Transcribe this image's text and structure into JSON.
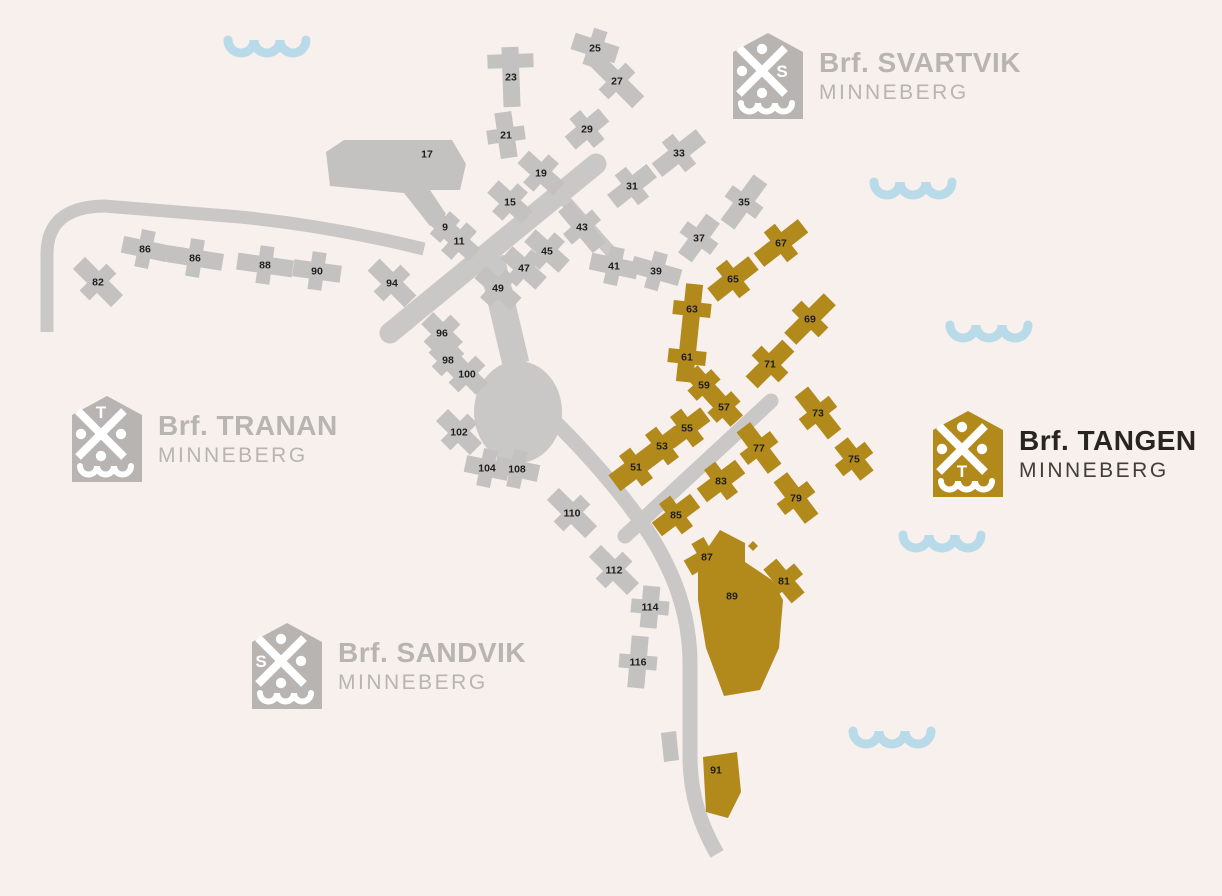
{
  "page": {
    "background": "#f7f0ec"
  },
  "colors": {
    "background": "#f7f0ec",
    "gray_building": "#c3c2c0",
    "road": "#c9c8c6",
    "gold": "#b28a1c",
    "wave": "#b9dbe9",
    "label": "#1d1d1b",
    "logo_gray": "#b7b4b1",
    "logo_dark_title": "#282520",
    "logo_dark_sub": "#413e37",
    "icon_glyph": "#ffffff"
  },
  "legend": {
    "items": [
      {
        "id": "svartvik",
        "label": "Brf. SVARTVIK",
        "subtitle": "MINNEBERG",
        "letter": "S",
        "letter_pos": "right",
        "theme": "gray",
        "x": 733,
        "y": 33
      },
      {
        "id": "tranan",
        "label": "Brf. TRANAN",
        "subtitle": "MINNEBERG",
        "letter": "T",
        "letter_pos": "top",
        "theme": "gray",
        "x": 72,
        "y": 396
      },
      {
        "id": "sandvik",
        "label": "Brf. SANDVIK",
        "subtitle": "MINNEBERG",
        "letter": "S",
        "letter_pos": "left",
        "theme": "gray",
        "x": 252,
        "y": 623
      },
      {
        "id": "tangen",
        "label": "Brf. TANGEN",
        "subtitle": "MINNEBERG",
        "letter": "T",
        "letter_pos": "bottom",
        "theme": "gold",
        "x": 933,
        "y": 411
      }
    ]
  },
  "map": {
    "roads": [
      {
        "name": "road-left-curve",
        "d": "M 47,332 L 47,254 Q 47,207 104,206 L 240,217 Q 330,226 424,249",
        "w": 13,
        "cap": "butt"
      },
      {
        "name": "road-main-diagonal",
        "d": "M 596,164 L 390,333",
        "w": 21,
        "cap": "round"
      },
      {
        "name": "road-northeast-branch",
        "d": "M 562,197 L 618,260",
        "w": 12,
        "cap": "butt"
      },
      {
        "name": "road-junction-connector",
        "d": "M 491,258 L 516,364",
        "w": 27,
        "cap": "butt"
      },
      {
        "name": "road-south",
        "d": "M 518,388 C 570,432 624,494 652,538 C 674,574 690,614 690,664 L 690,756 C 690,794 700,824 717,854",
        "w": 15,
        "cap": "butt"
      },
      {
        "name": "road-tangen-spur",
        "d": "M 771,401 L 625,536",
        "w": 15,
        "cap": "round"
      }
    ],
    "road_blob": {
      "cx": 518,
      "cy": 412,
      "rx": 44,
      "ry": 51
    },
    "buildings": [
      {
        "label": "25",
        "x": 595,
        "y": 48,
        "rot": 18,
        "len": 46,
        "type": "gray"
      },
      {
        "label": "27",
        "x": 617,
        "y": 81,
        "rot": 45,
        "len": 60,
        "type": "gray"
      },
      {
        "label": "23",
        "x": 511,
        "y": 77,
        "rot": 88,
        "len": 60,
        "ao": -16,
        "al": 46,
        "type": "gray"
      },
      {
        "label": "21",
        "x": 506,
        "y": 135,
        "rot": 82,
        "len": 46,
        "type": "gray"
      },
      {
        "label": "29",
        "x": 587,
        "y": 129,
        "rot": -40,
        "len": 44,
        "type": "gray"
      },
      {
        "label": "33",
        "x": 679,
        "y": 153,
        "rot": -38,
        "len": 56,
        "type": "gray"
      },
      {
        "label": "17",
        "x": 427,
        "y": 154,
        "type": "gray",
        "poly": "326,152 344,140 452,140 466,164 460,190 430,190 446,214 430,226 404,193 330,186"
      },
      {
        "label": "19",
        "x": 541,
        "y": 173,
        "rot": 42,
        "len": 48,
        "type": "gray"
      },
      {
        "label": "31",
        "x": 632,
        "y": 186,
        "rot": -38,
        "len": 50,
        "type": "gray"
      },
      {
        "label": "35",
        "x": 744,
        "y": 202,
        "rot": -54,
        "len": 56,
        "type": "gray"
      },
      {
        "label": "15",
        "x": 510,
        "y": 202,
        "rot": 42,
        "len": 46,
        "type": "gray"
      },
      {
        "label": "9",
        "x": 445,
        "y": 227,
        "rot": 42,
        "len": 36,
        "al": 30,
        "type": "gray"
      },
      {
        "label": "11",
        "x": 459,
        "y": 241,
        "rot": 42,
        "len": 42,
        "type": "gray"
      },
      {
        "label": "43",
        "x": 582,
        "y": 227,
        "rot": 50,
        "len": 54,
        "type": "gray"
      },
      {
        "label": "37",
        "x": 699,
        "y": 238,
        "rot": -54,
        "len": 48,
        "type": "gray"
      },
      {
        "label": "45",
        "x": 547,
        "y": 251,
        "rot": 42,
        "len": 46,
        "type": "gray"
      },
      {
        "label": "47",
        "x": 524,
        "y": 268,
        "rot": 42,
        "len": 46,
        "type": "gray"
      },
      {
        "label": "41",
        "x": 614,
        "y": 266,
        "rot": 12,
        "len": 48,
        "type": "gray"
      },
      {
        "label": "39",
        "x": 656,
        "y": 271,
        "rot": 16,
        "len": 50,
        "type": "gray"
      },
      {
        "label": "49",
        "x": 498,
        "y": 288,
        "rot": 42,
        "len": 48,
        "type": "gray"
      },
      {
        "label": "86",
        "x": 145,
        "y": 249,
        "rot": 12,
        "len": 46,
        "type": "gray"
      },
      {
        "label": "86",
        "x": 195,
        "y": 258,
        "rot": 9,
        "len": 56,
        "type": "gray"
      },
      {
        "label": "88",
        "x": 265,
        "y": 265,
        "rot": 8,
        "len": 56,
        "type": "gray"
      },
      {
        "label": "90",
        "x": 317,
        "y": 271,
        "rot": 8,
        "len": 48,
        "type": "gray"
      },
      {
        "label": "82",
        "x": 98,
        "y": 282,
        "rot": 45,
        "len": 54,
        "type": "gray"
      },
      {
        "label": "94",
        "x": 392,
        "y": 283,
        "rot": 45,
        "len": 52,
        "type": "gray"
      },
      {
        "label": "96",
        "x": 442,
        "y": 333,
        "rot": 45,
        "len": 42,
        "type": "gray"
      },
      {
        "label": "98",
        "x": 448,
        "y": 360,
        "rot": 45,
        "len": 38,
        "al": 32,
        "type": "gray"
      },
      {
        "label": "100",
        "x": 467,
        "y": 374,
        "rot": 45,
        "len": 42,
        "type": "gray"
      },
      {
        "label": "102",
        "x": 459,
        "y": 432,
        "rot": 45,
        "len": 48,
        "type": "gray"
      },
      {
        "label": "104",
        "x": 487,
        "y": 468,
        "rot": 12,
        "len": 44,
        "type": "gray"
      },
      {
        "label": "108",
        "x": 517,
        "y": 469,
        "rot": 12,
        "len": 44,
        "type": "gray"
      },
      {
        "label": "110",
        "x": 572,
        "y": 513,
        "rot": 45,
        "len": 54,
        "type": "gray"
      },
      {
        "label": "112",
        "x": 614,
        "y": 570,
        "rot": 45,
        "len": 54,
        "type": "gray"
      },
      {
        "label": "114",
        "x": 650,
        "y": 607,
        "rot": 95,
        "len": 42,
        "type": "gray"
      },
      {
        "label": "116",
        "x": 638,
        "y": 662,
        "rot": 95,
        "len": 52,
        "type": "gray"
      },
      {
        "label": "",
        "type": "gray",
        "poly": "661,733 676,731 679,760 664,762"
      },
      {
        "label": "67",
        "x": 781,
        "y": 243,
        "rot": -38,
        "len": 56,
        "type": "gold"
      },
      {
        "label": "65",
        "x": 733,
        "y": 279,
        "rot": -38,
        "len": 52,
        "type": "gold"
      },
      {
        "label": "63",
        "x": 692,
        "y": 309,
        "rot": 96,
        "len": 50,
        "type": "gold"
      },
      {
        "label": "61",
        "x": 687,
        "y": 357,
        "rot": 96,
        "len": 50,
        "type": "gold"
      },
      {
        "label": "59",
        "x": 704,
        "y": 385,
        "rot": 48,
        "len": 38,
        "al": 32,
        "type": "gold"
      },
      {
        "label": "57",
        "x": 724,
        "y": 407,
        "rot": 48,
        "len": 38,
        "al": 32,
        "type": "gold"
      },
      {
        "label": "69",
        "x": 810,
        "y": 319,
        "rot": -45,
        "len": 56,
        "type": "gold"
      },
      {
        "label": "71",
        "x": 770,
        "y": 364,
        "rot": -45,
        "len": 52,
        "type": "gold"
      },
      {
        "label": "73",
        "x": 818,
        "y": 413,
        "rot": 52,
        "len": 54,
        "type": "gold"
      },
      {
        "label": "75",
        "x": 854,
        "y": 459,
        "rot": 52,
        "len": 42,
        "type": "gold"
      },
      {
        "label": "55",
        "x": 687,
        "y": 428,
        "rot": -37,
        "len": 46,
        "type": "gold"
      },
      {
        "label": "53",
        "x": 662,
        "y": 446,
        "rot": -37,
        "len": 46,
        "type": "gold"
      },
      {
        "label": "51",
        "x": 636,
        "y": 467,
        "rot": -37,
        "len": 54,
        "w": 20,
        "type": "gold"
      },
      {
        "label": "77",
        "x": 759,
        "y": 448,
        "rot": 53,
        "len": 52,
        "type": "gold"
      },
      {
        "label": "79",
        "x": 796,
        "y": 498,
        "rot": 53,
        "len": 52,
        "type": "gold"
      },
      {
        "label": "83",
        "x": 721,
        "y": 481,
        "rot": -37,
        "len": 48,
        "type": "gold"
      },
      {
        "label": "85",
        "x": 676,
        "y": 515,
        "rot": -37,
        "len": 48,
        "type": "gold"
      },
      {
        "label": "87",
        "x": 707,
        "y": 557,
        "rot": -30,
        "len": 44,
        "type": "gold"
      },
      {
        "label": "81",
        "x": 784,
        "y": 581,
        "rot": 50,
        "len": 44,
        "type": "gold"
      },
      {
        "label": "",
        "type": "gold",
        "poly": "748,546 753,541 758,546 753,551"
      },
      {
        "label": "89",
        "x": 732,
        "y": 596,
        "type": "gold",
        "poly": "698,562 720,530 745,543 745,562 772,580 783,600 779,648 760,690 724,696 706,648 698,600"
      },
      {
        "label": "91",
        "x": 716,
        "y": 770,
        "type": "gold",
        "poly": "703,757 737,752 741,792 728,818 706,812"
      }
    ],
    "waves": [
      {
        "x": 228,
        "y": 40
      },
      {
        "x": 874,
        "y": 182
      },
      {
        "x": 950,
        "y": 325
      },
      {
        "x": 903,
        "y": 535
      },
      {
        "x": 853,
        "y": 731
      }
    ]
  }
}
